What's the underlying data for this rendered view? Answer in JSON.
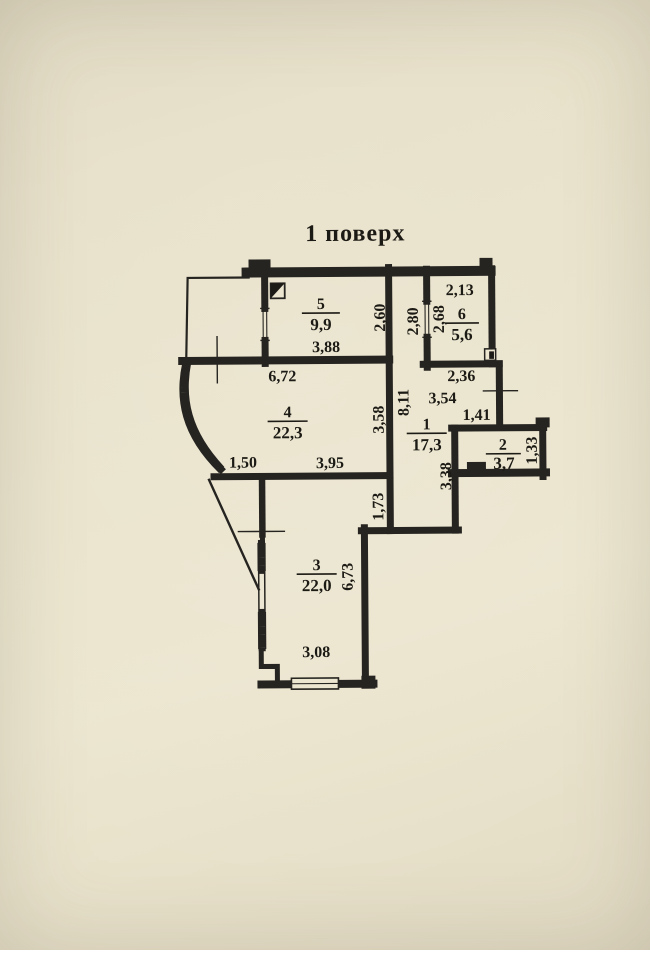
{
  "title": "1 поверх",
  "floor_plan": {
    "rooms": {
      "r1": {
        "number": "1",
        "area": "17,3"
      },
      "r2": {
        "number": "2",
        "area": "3,7"
      },
      "r3": {
        "number": "3",
        "area": "22,0"
      },
      "r4": {
        "number": "4",
        "area": "22,3"
      },
      "r5": {
        "number": "5",
        "area": "9,9"
      },
      "r6": {
        "number": "6",
        "area": "5,6"
      }
    },
    "dimensions": {
      "d213": "2,13",
      "d268": "2,68",
      "d280": "2,80",
      "d260": "2,60",
      "d388": "3,88",
      "d672": "6,72",
      "d236": "2,36",
      "d354": "3,54",
      "d141": "1,41",
      "d811": "8,11",
      "d358": "3,58",
      "d150": "1,50",
      "d395": "3,95",
      "d338": "3,38",
      "d133": "1,33",
      "d173": "1,73",
      "d673": "6,73",
      "d308": "3,08"
    },
    "colors": {
      "paper": "#eae4cd",
      "ink": "#262420"
    }
  }
}
